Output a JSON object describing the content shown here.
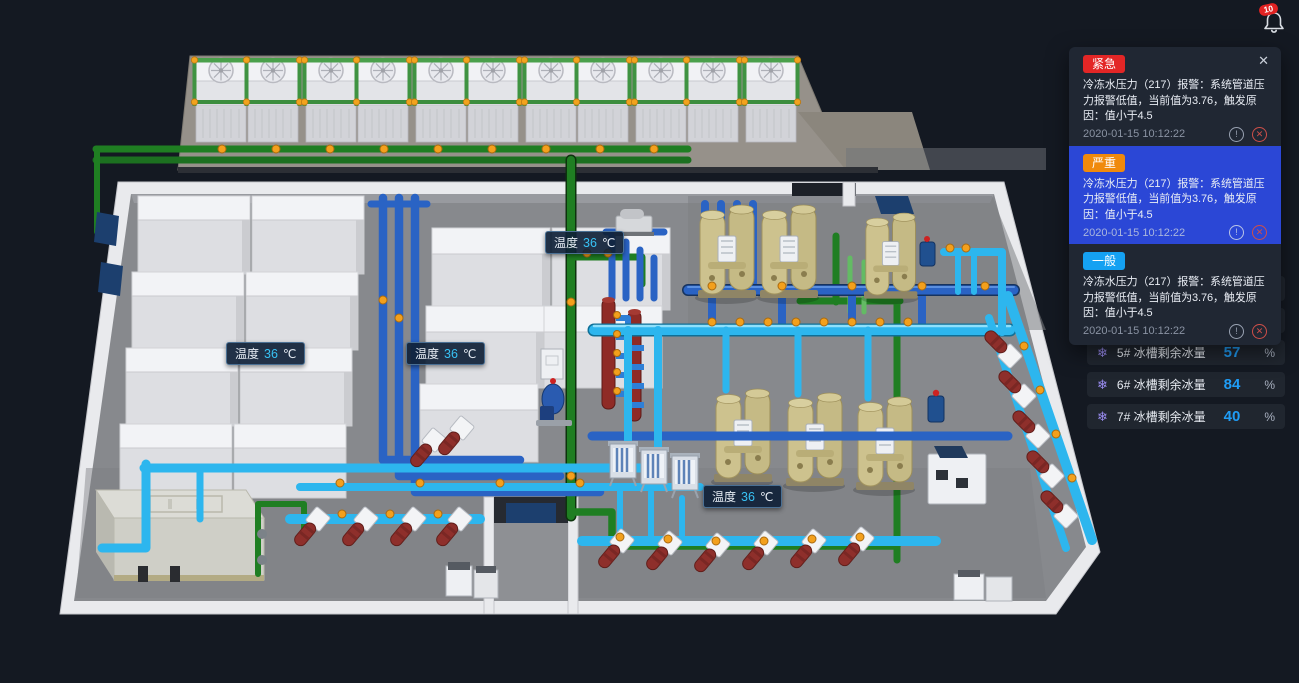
{
  "header": {
    "bell_badge_count": "10"
  },
  "scene": {
    "temperature_labels": [
      {
        "label": "温度",
        "value": "36",
        "unit": "℃"
      },
      {
        "label": "温度",
        "value": "36",
        "unit": "℃"
      },
      {
        "label": "温度",
        "value": "36",
        "unit": "℃"
      },
      {
        "label": "温度",
        "value": "36",
        "unit": "℃"
      }
    ]
  },
  "alarm_panel": {
    "close_icon": "✕",
    "alarms": [
      {
        "severity": "紧急",
        "message": "冷冻水压力（217）报警：系统管道压力报警低值，当前值为3.76，触发原因：值小于4.5",
        "timestamp": "2020-01-15  10:12:22",
        "info_icon": "!",
        "dismiss_icon": "✕",
        "selected": false
      },
      {
        "severity": "严重",
        "message": "冷冻水压力（217）报警：系统管道压力报警低值，当前值为3.76，触发原因：值小于4.5",
        "timestamp": "2020-01-15  10:12:22",
        "info_icon": "!",
        "dismiss_icon": "✕",
        "selected": true
      },
      {
        "severity": "一般",
        "message": "冷冻水压力（217）报警：系统管道压力报警低值，当前值为3.76，触发原因：值小于4.5",
        "timestamp": "2020-01-15  10:12:22",
        "info_icon": "!",
        "dismiss_icon": "✕",
        "selected": false
      }
    ]
  },
  "ice_storage_list": {
    "items": [
      {
        "icon": "❄",
        "name": "3# 冰槽剩余冰量",
        "value": "74",
        "unit": "%"
      },
      {
        "icon": "❄",
        "name": "4# 冰槽剩余冰量",
        "value": "78",
        "unit": "%"
      },
      {
        "icon": "❄",
        "name": "5# 冰槽剩余冰量",
        "value": "57",
        "unit": "%"
      },
      {
        "icon": "❄",
        "name": "6# 冰槽剩余冰量",
        "value": "84",
        "unit": "%"
      },
      {
        "icon": "❄",
        "name": "7# 冰槽剩余冰量",
        "value": "40",
        "unit": "%"
      }
    ]
  },
  "colors": {
    "severity_urgent": "#e32626",
    "severity_severe": "#f08a0c",
    "severity_general": "#15a1f2",
    "selected_alarm_bg": "#2b47d6",
    "value_accent": "#1f9cf5",
    "temperature_accent": "#38c2f4"
  }
}
